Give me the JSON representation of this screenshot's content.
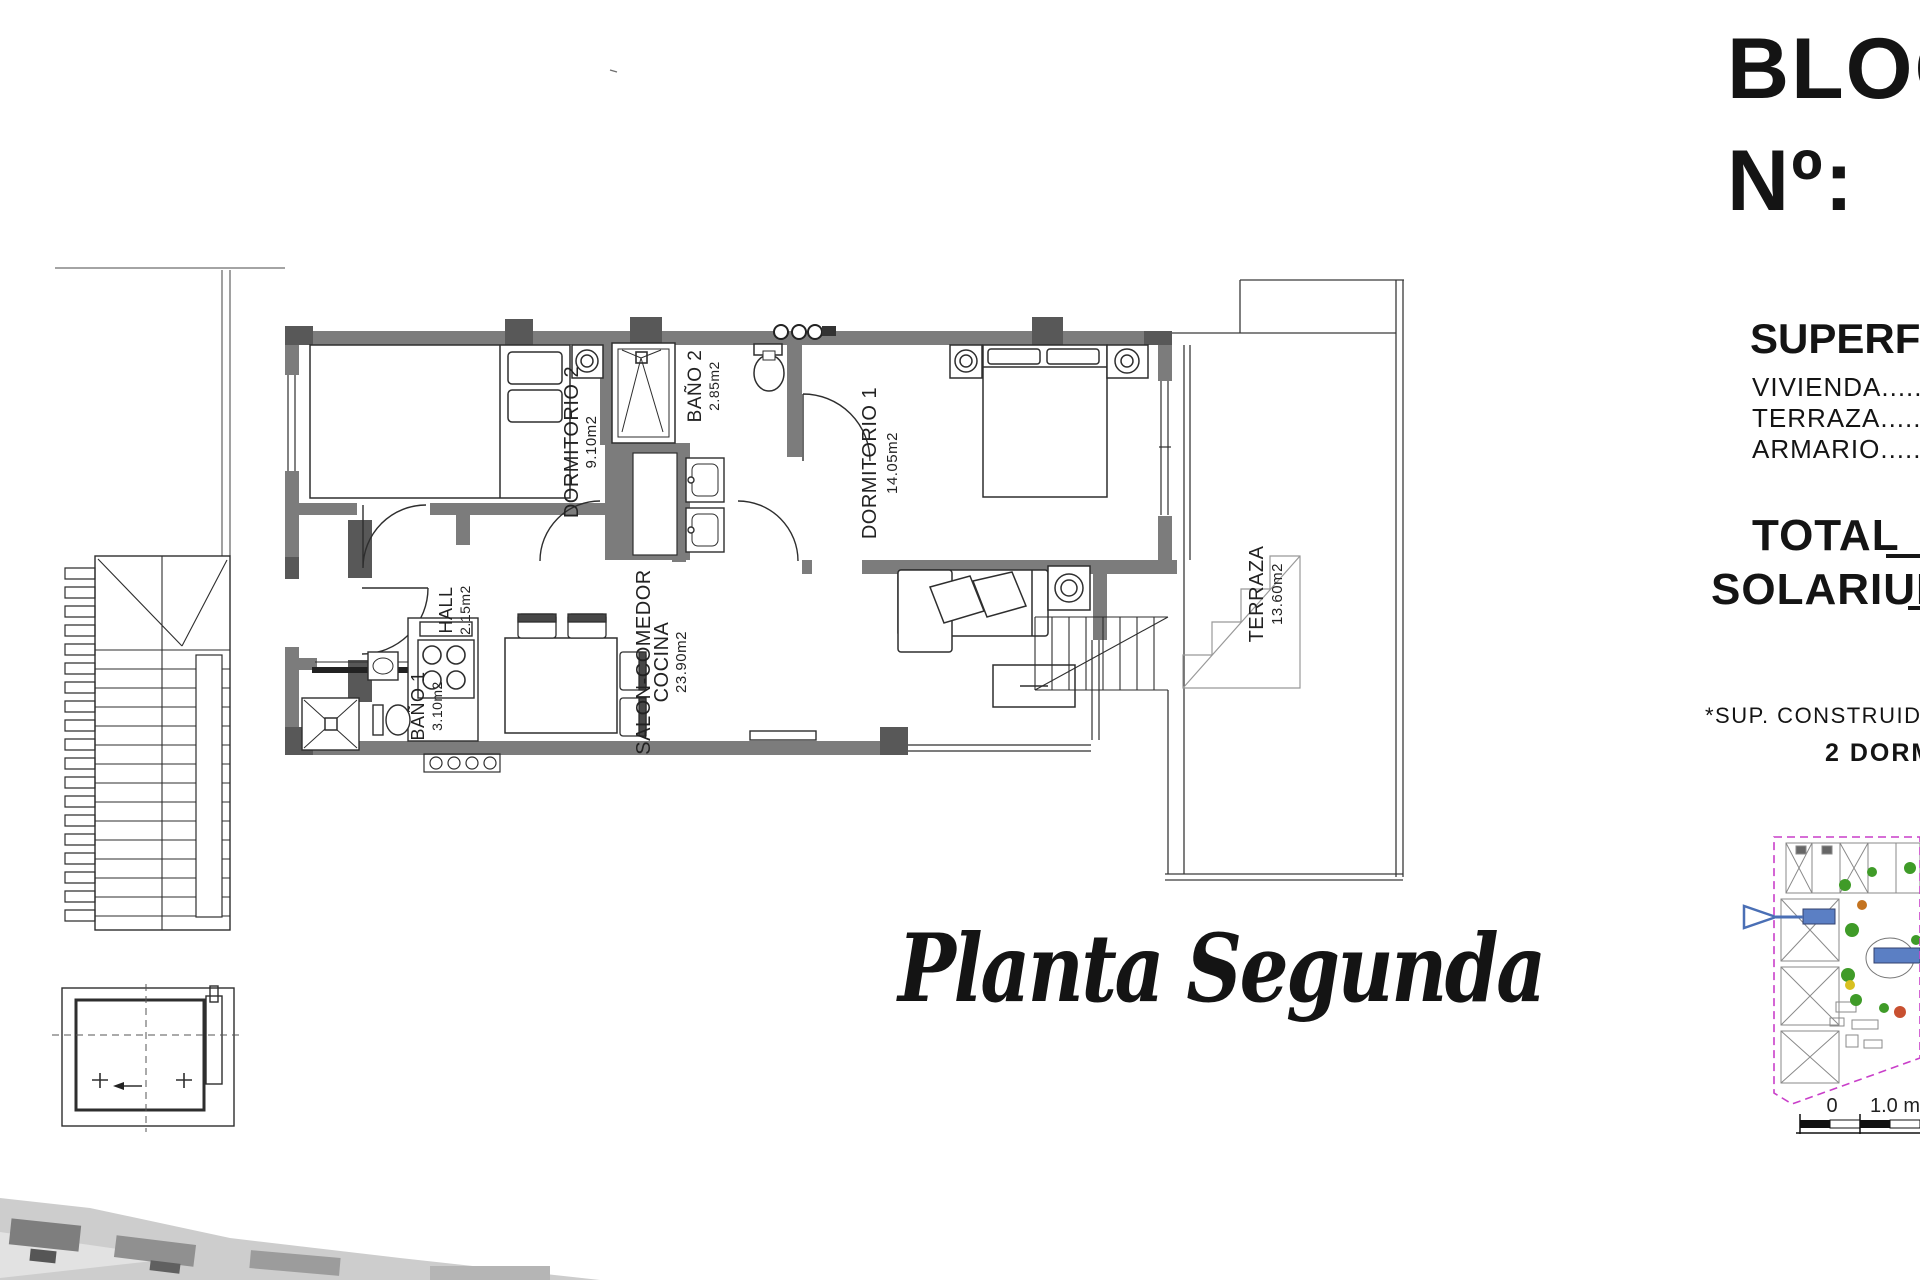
{
  "header": {
    "block_label": "BLOQUE",
    "number_label": "Nº:"
  },
  "surfaces": {
    "title": "SUPERFICIES",
    "rows": [
      "VIVIENDA..........................",
      "TERRAZA..........................",
      "ARMARIO.........................."
    ],
    "total_label": "TOTAL",
    "solarium_label": "SOLARIUM"
  },
  "notes": {
    "construida": "*SUP. CONSTRUIDA",
    "bedrooms": "2 DORMITORIOS"
  },
  "plan_title": "Planta Segunda",
  "rooms": {
    "dormitorio2": {
      "name": "DORMITORIO 2",
      "area": "9.10m2"
    },
    "bano2": {
      "name": "BAÑO 2",
      "area": "2.85m2"
    },
    "dormitorio1": {
      "name": "DORMITORIO 1",
      "area": "14.05m2"
    },
    "hall": {
      "name": "HALL",
      "area": "2.15m2"
    },
    "bano1": {
      "name": "BAÑO 1",
      "area": "3.10m2"
    },
    "salon": {
      "name": "SALON-COMEDOR",
      "name2": "COCINA",
      "area": "23.90m2"
    },
    "terraza": {
      "name": "TERRAZA",
      "area": "13.60m2"
    }
  },
  "scale_bar": {
    "start": "0",
    "end": "1.0 m"
  },
  "site_map": {
    "boundary_color": "#c93fc9",
    "building_color": "#5b7fc4",
    "tree_color": "#3f9b28",
    "accent_orange": "#c4731f",
    "accent_yellow": "#d8c020"
  },
  "colors": {
    "wall": "#7c7c7c",
    "wall_dark": "#585858",
    "line": "#2e2e2e"
  }
}
